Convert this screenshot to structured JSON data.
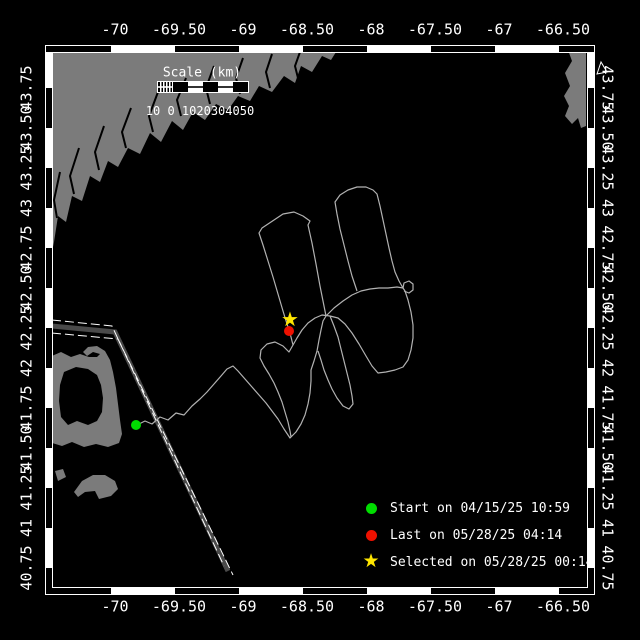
{
  "figure": {
    "colors": {
      "background": "#000000",
      "land": "#7b7b7b",
      "track": "#b2b2b2",
      "corridor_fill": "#4a4a4a",
      "frame": "#ffffff",
      "text": "#ffffff",
      "start_green": "#00dd00",
      "last_red": "#ee1100",
      "selected_yellow": "#ffe600"
    }
  },
  "axes": {
    "lon_labels": [
      "-70",
      "-69.50",
      "-69",
      "-68.50",
      "-68",
      "-67.50",
      "-67",
      "-66.50"
    ],
    "lat_labels": [
      "43.75",
      "43.50",
      "43.25",
      "43",
      "42.75",
      "42.50",
      "42.25",
      "42",
      "41.75",
      "41.50",
      "41.25",
      "41",
      "40.75"
    ]
  },
  "scale_bar": {
    "title": "Scale (km)",
    "tick_text": "10 0 1020304050"
  },
  "legend": {
    "items": [
      {
        "marker": "dot",
        "color": "#00dd00",
        "label": "Start on 04/15/25 10:59"
      },
      {
        "marker": "dot",
        "color": "#ee1100",
        "label": "Last on 05/28/25 04:14"
      },
      {
        "marker": "star",
        "color": "#ffe600",
        "glyph": "★",
        "label": "Selected on 05/28/25 00:14"
      }
    ]
  },
  "markers": [
    {
      "name": "start-marker",
      "type": "dot",
      "color": "#00dd00",
      "x": 136,
      "y": 425
    },
    {
      "name": "last-marker",
      "type": "dot",
      "color": "#ee1100",
      "x": 289,
      "y": 331
    },
    {
      "name": "selected-marker",
      "type": "star",
      "color": "#ffe600",
      "glyph": "★",
      "x": 290,
      "y": 320
    }
  ],
  "map": {
    "land": {
      "maine_coast": [
        [
          52,
          52
        ],
        [
          336,
          52
        ],
        [
          331,
          60
        ],
        [
          322,
          56
        ],
        [
          312,
          72
        ],
        [
          301,
          66
        ],
        [
          295,
          83
        ],
        [
          284,
          76
        ],
        [
          272,
          92
        ],
        [
          259,
          86
        ],
        [
          250,
          101
        ],
        [
          238,
          96
        ],
        [
          228,
          110
        ],
        [
          216,
          104
        ],
        [
          205,
          120
        ],
        [
          193,
          112
        ],
        [
          183,
          130
        ],
        [
          172,
          121
        ],
        [
          161,
          142
        ],
        [
          150,
          133
        ],
        [
          140,
          154
        ],
        [
          128,
          148
        ],
        [
          118,
          167
        ],
        [
          108,
          161
        ],
        [
          100,
          182
        ],
        [
          90,
          176
        ],
        [
          82,
          201
        ],
        [
          72,
          196
        ],
        [
          66,
          222
        ],
        [
          58,
          216
        ],
        [
          54,
          242
        ],
        [
          52,
          252
        ]
      ],
      "nova_scotia": [
        [
          586,
          50
        ],
        [
          568,
          50
        ],
        [
          572,
          61
        ],
        [
          565,
          73
        ],
        [
          570,
          86
        ],
        [
          564,
          96
        ],
        [
          569,
          106
        ],
        [
          565,
          116
        ],
        [
          572,
          124
        ],
        [
          578,
          118
        ],
        [
          581,
          128
        ],
        [
          586,
          126
        ]
      ],
      "cape_cod_outer": [
        [
          52,
          356
        ],
        [
          61,
          352
        ],
        [
          71,
          357
        ],
        [
          80,
          354
        ],
        [
          89,
          357
        ],
        [
          97,
          357
        ],
        [
          100,
          354
        ],
        [
          93,
          352
        ],
        [
          87,
          356
        ],
        [
          83,
          352
        ],
        [
          88,
          347
        ],
        [
          97,
          346
        ],
        [
          105,
          351
        ],
        [
          110,
          360
        ],
        [
          113,
          372
        ],
        [
          116,
          388
        ],
        [
          118,
          404
        ],
        [
          120,
          420
        ],
        [
          122,
          434
        ],
        [
          119,
          443
        ],
        [
          108,
          447
        ],
        [
          96,
          444
        ],
        [
          84,
          447
        ],
        [
          72,
          442
        ],
        [
          62,
          446
        ],
        [
          52,
          443
        ]
      ],
      "cape_cod_bay_hole": [
        [
          64,
          372
        ],
        [
          76,
          367
        ],
        [
          88,
          369
        ],
        [
          97,
          375
        ],
        [
          101,
          385
        ],
        [
          103,
          398
        ],
        [
          102,
          412
        ],
        [
          97,
          421
        ],
        [
          88,
          425
        ],
        [
          77,
          421
        ],
        [
          68,
          425
        ],
        [
          61,
          417
        ],
        [
          59,
          401
        ],
        [
          60,
          385
        ]
      ],
      "island_crescent": [
        [
          74,
          492
        ],
        [
          82,
          481
        ],
        [
          93,
          475
        ],
        [
          105,
          475
        ],
        [
          115,
          481
        ],
        [
          118,
          489
        ],
        [
          111,
          496
        ],
        [
          99,
          499
        ],
        [
          95,
          491
        ],
        [
          85,
          492
        ],
        [
          78,
          497
        ]
      ],
      "island_blob": [
        [
          55,
          471
        ],
        [
          63,
          469
        ],
        [
          66,
          477
        ],
        [
          58,
          481
        ]
      ]
    },
    "rivers": [
      [
        [
          300,
          52
        ],
        [
          295,
          66
        ],
        [
          298,
          78
        ]
      ],
      [
        [
          272,
          54
        ],
        [
          266,
          72
        ],
        [
          270,
          88
        ]
      ],
      [
        [
          243,
          58
        ],
        [
          236,
          78
        ],
        [
          240,
          94
        ]
      ],
      [
        [
          214,
          66
        ],
        [
          206,
          88
        ],
        [
          210,
          104
        ]
      ],
      [
        [
          186,
          78
        ],
        [
          177,
          100
        ],
        [
          181,
          116
        ]
      ],
      [
        [
          158,
          92
        ],
        [
          149,
          116
        ],
        [
          153,
          132
        ]
      ],
      [
        [
          131,
          108
        ],
        [
          122,
          132
        ],
        [
          126,
          148
        ]
      ],
      [
        [
          104,
          126
        ],
        [
          95,
          152
        ],
        [
          99,
          170
        ]
      ],
      [
        [
          79,
          148
        ],
        [
          70,
          176
        ],
        [
          74,
          194
        ]
      ],
      [
        [
          60,
          172
        ],
        [
          54,
          200
        ],
        [
          57,
          218
        ]
      ]
    ],
    "corridor": {
      "band": [
        [
          52,
          326
        ],
        [
          115,
          332
        ],
        [
          228,
          571
        ]
      ],
      "edge_a": [
        [
          52,
          320
        ],
        [
          112,
          326
        ],
        [
          224,
          566
        ]
      ],
      "edge_b": [
        [
          52,
          333
        ],
        [
          118,
          339
        ],
        [
          233,
          575
        ]
      ]
    },
    "track_segments": [
      [
        [
          137,
          425
        ],
        [
          145,
          421
        ],
        [
          152,
          424
        ],
        [
          160,
          417
        ],
        [
          168,
          420
        ],
        [
          176,
          413
        ],
        [
          184,
          415
        ],
        [
          192,
          406
        ],
        [
          200,
          399
        ],
        [
          207,
          392
        ],
        [
          214,
          384
        ],
        [
          221,
          376
        ],
        [
          227,
          369
        ],
        [
          233,
          366
        ],
        [
          238,
          371
        ],
        [
          245,
          379
        ],
        [
          252,
          387
        ],
        [
          259,
          395
        ],
        [
          266,
          403
        ],
        [
          272,
          411
        ],
        [
          278,
          419
        ],
        [
          284,
          429
        ],
        [
          290,
          438
        ],
        [
          296,
          432
        ],
        [
          301,
          424
        ],
        [
          305,
          415
        ],
        [
          308,
          404
        ],
        [
          310,
          393
        ],
        [
          311,
          381
        ],
        [
          311,
          370
        ],
        [
          314,
          361
        ],
        [
          317,
          351
        ],
        [
          319,
          340
        ],
        [
          321,
          330
        ],
        [
          323,
          321
        ],
        [
          326,
          316
        ],
        [
          324,
          306
        ],
        [
          320,
          286
        ],
        [
          316,
          264
        ],
        [
          312,
          243
        ],
        [
          308,
          225
        ],
        [
          310,
          221
        ],
        [
          303,
          216
        ],
        [
          294,
          212
        ],
        [
          283,
          214
        ],
        [
          271,
          222
        ],
        [
          262,
          228
        ],
        [
          259,
          233
        ],
        [
          263,
          245
        ],
        [
          268,
          261
        ],
        [
          273,
          277
        ],
        [
          278,
          294
        ],
        [
          283,
          311
        ],
        [
          287,
          324
        ],
        [
          290,
          333
        ],
        [
          293,
          345
        ],
        [
          289,
          352
        ],
        [
          283,
          346
        ],
        [
          275,
          342
        ],
        [
          267,
          344
        ],
        [
          261,
          350
        ],
        [
          260,
          358
        ],
        [
          264,
          366
        ],
        [
          269,
          374
        ],
        [
          274,
          383
        ],
        [
          278,
          392
        ],
        [
          282,
          402
        ],
        [
          285,
          412
        ],
        [
          288,
          422
        ],
        [
          290,
          431
        ],
        [
          291,
          437
        ]
      ],
      [
        [
          293,
          345
        ],
        [
          297,
          338
        ],
        [
          302,
          330
        ],
        [
          308,
          323
        ],
        [
          315,
          318
        ],
        [
          322,
          315
        ],
        [
          330,
          316
        ],
        [
          338,
          318
        ],
        [
          345,
          324
        ],
        [
          352,
          333
        ],
        [
          359,
          344
        ],
        [
          366,
          356
        ],
        [
          372,
          366
        ],
        [
          378,
          373
        ],
        [
          386,
          372
        ],
        [
          395,
          370
        ],
        [
          403,
          367
        ],
        [
          408,
          360
        ],
        [
          411,
          350
        ],
        [
          413,
          338
        ],
        [
          413,
          325
        ],
        [
          411,
          312
        ],
        [
          408,
          300
        ],
        [
          405,
          291
        ],
        [
          403,
          288
        ],
        [
          397,
          287
        ],
        [
          388,
          288
        ],
        [
          379,
          288
        ],
        [
          370,
          289
        ],
        [
          361,
          291
        ],
        [
          352,
          295
        ],
        [
          343,
          301
        ],
        [
          334,
          308
        ],
        [
          326,
          316
        ]
      ],
      [
        [
          403,
          288
        ],
        [
          404,
          283
        ],
        [
          409,
          281
        ],
        [
          413,
          284
        ],
        [
          413,
          290
        ],
        [
          409,
          293
        ],
        [
          404,
          291
        ]
      ],
      [
        [
          357,
          291
        ],
        [
          352,
          276
        ],
        [
          348,
          261
        ],
        [
          344,
          245
        ],
        [
          340,
          229
        ],
        [
          337,
          214
        ],
        [
          335,
          202
        ],
        [
          340,
          195
        ],
        [
          348,
          190
        ],
        [
          357,
          187
        ],
        [
          366,
          187
        ],
        [
          373,
          190
        ],
        [
          377,
          194
        ],
        [
          380,
          206
        ],
        [
          383,
          220
        ],
        [
          386,
          234
        ],
        [
          389,
          248
        ],
        [
          392,
          261
        ],
        [
          395,
          272
        ],
        [
          399,
          281
        ],
        [
          403,
          288
        ]
      ],
      [
        [
          330,
          316
        ],
        [
          334,
          326
        ],
        [
          338,
          337
        ],
        [
          341,
          349
        ],
        [
          344,
          361
        ],
        [
          347,
          373
        ],
        [
          350,
          385
        ],
        [
          352,
          396
        ],
        [
          353,
          404
        ],
        [
          349,
          409
        ],
        [
          343,
          406
        ],
        [
          337,
          398
        ],
        [
          332,
          389
        ],
        [
          328,
          380
        ],
        [
          324,
          370
        ],
        [
          321,
          360
        ],
        [
          318,
          351
        ]
      ]
    ]
  }
}
